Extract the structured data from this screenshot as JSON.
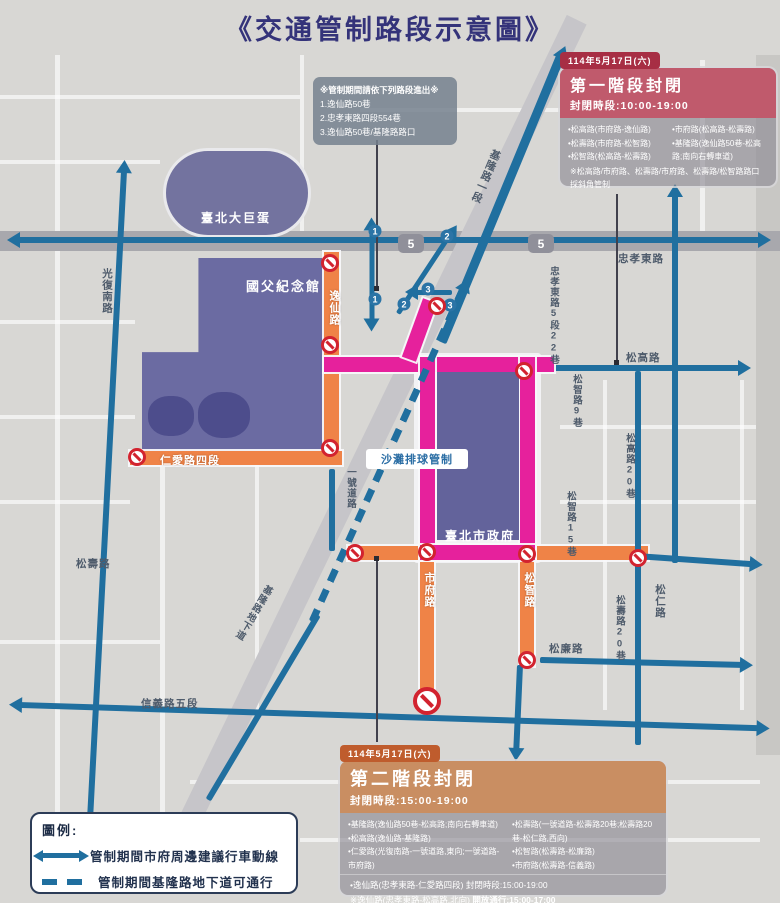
{
  "title": "《交通管制路段示意圖》",
  "access_note": {
    "heading": "※管制期間請依下列路段進出※",
    "items": [
      "1.逸仙路50巷",
      "2.忠孝東路四段554巷",
      "3.逸仙路50巷/基隆路路口"
    ]
  },
  "phase1": {
    "date": "114年5月17日(六)",
    "title": "第一階段封閉",
    "time_label": "封閉時段:10:00-19:00",
    "items_left": [
      "•松高路(市府路-逸仙路)",
      "•松壽路(市府路-松智路)",
      "•松智路(松高路-松壽路)"
    ],
    "items_right": [
      "•市府路(松高路-松壽路)",
      "•基隆路(逸仙路50巷-松高路;南向右轉車道)"
    ],
    "note": "※松高路/市府路、松壽路/市府路、松壽路/松智路路口採斜角管制"
  },
  "phase2": {
    "date": "114年5月17日(六)",
    "title": "第二階段封閉",
    "time_label": "封閉時段:15:00-19:00",
    "items_left": [
      "•基隆路(逸仙路50巷-松高路;南向右轉車道)",
      "•松高路(逸仙路-基隆路)",
      "•仁愛路(光復南路-一號道路,東向;一號道路-市府路)"
    ],
    "items_right": [
      "•松壽路(一號道路-松壽路20巷;松壽路20巷-松仁路,西向)",
      "•松智路(松壽路-松廉路)",
      "•市府路(松壽路-信義路)"
    ],
    "extra": "•逸仙路(忠孝東路-仁愛路四段) 封閉時段:15:00-19:00",
    "open_prefix": "※逸仙路(忠孝東路-松高路,北向) ",
    "open_underline": "開放通行:15:00-17:00"
  },
  "legend": {
    "heading": "圖例:",
    "route_label": "管制期間市府周邊建議行車動線",
    "underpass_label": "管制期間基隆路地下道可通行"
  },
  "map": {
    "route_shield": "5",
    "badges": [
      "1",
      "2",
      "3"
    ],
    "buildings": {
      "dome": "臺北大巨蛋",
      "memorial": "國父紀念館",
      "cityhall": "臺北市政府"
    },
    "roads": {
      "guangfu": "光復南路",
      "zhongxiao": "忠孝東路",
      "zhongxiao22": "忠孝東路5段22巷",
      "keelung1": "基隆路一段",
      "keelung_underpass": "基隆路地下道",
      "yixian": "逸仙路",
      "renai4": "仁愛路四段",
      "yihao": "一號道路",
      "songshou_w": "松壽路",
      "shifu": "市府路",
      "songzhi": "松智路",
      "songgao": "松高路",
      "songzhi9": "松智路9巷",
      "songgao20": "松高路20巷",
      "songzhi15": "松智路15巷",
      "songren": "松仁路",
      "songshou20": "松壽路20巷",
      "songlian": "松廉路",
      "xinyi5": "信義路五段",
      "beach": "沙灘排球管制"
    },
    "colors": {
      "phase1_magenta": "#e6219c",
      "phase2_orange": "#ef8347",
      "route_blue": "#206f9f",
      "building_purple": "#6b6ba2"
    }
  }
}
